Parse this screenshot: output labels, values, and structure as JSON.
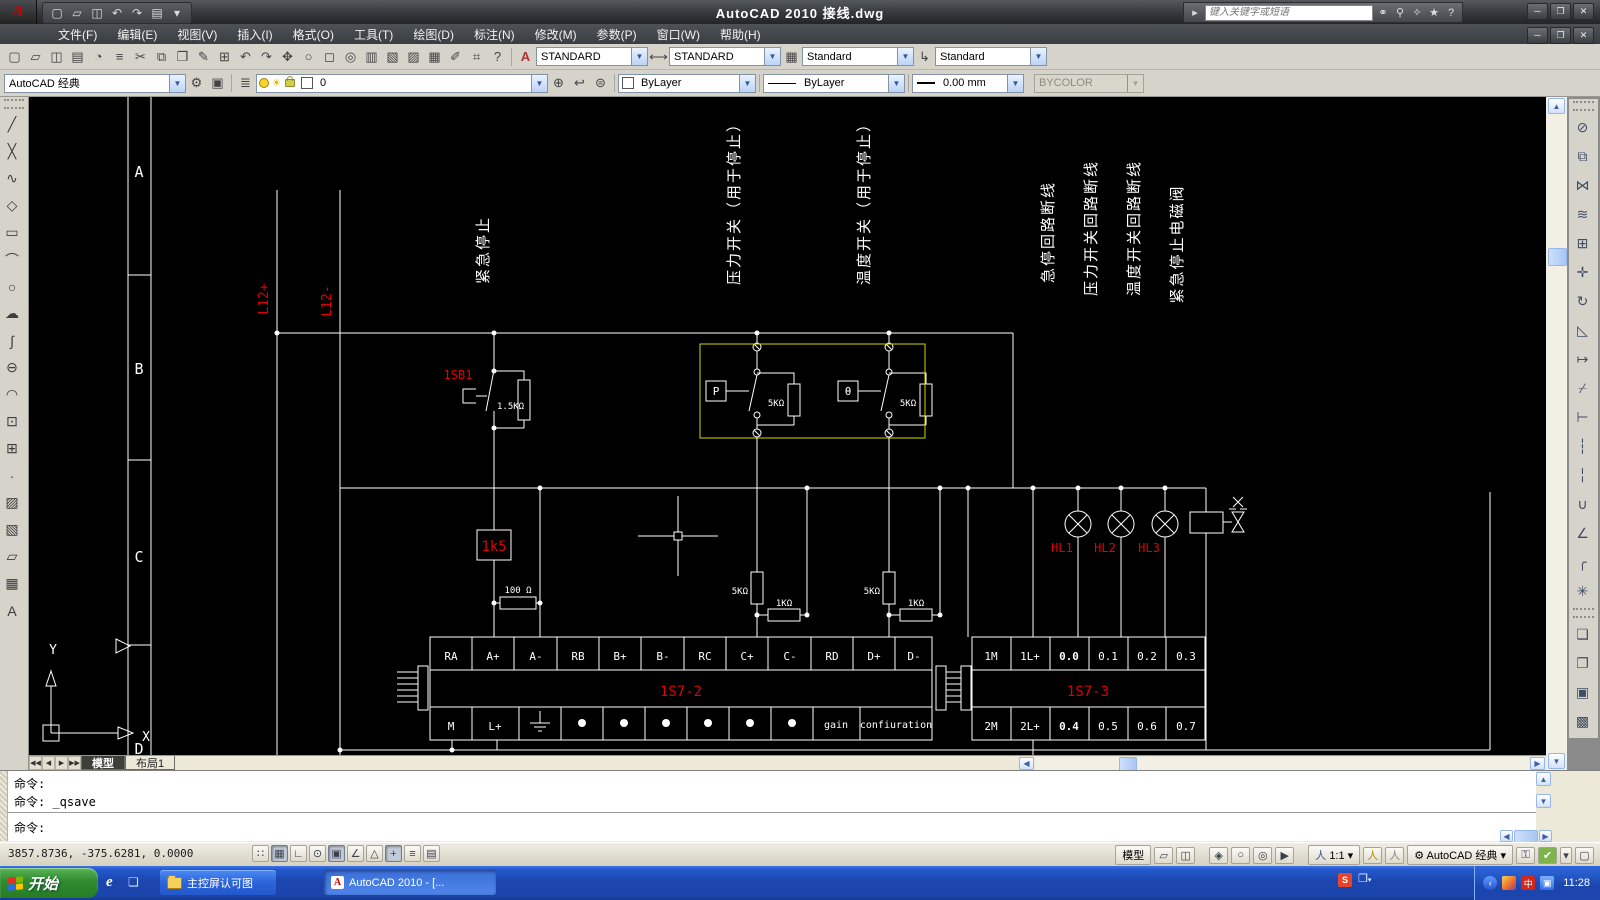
{
  "window": {
    "title": "AutoCAD 2010  接线.dwg",
    "search_placeholder": "键入关键字或短语"
  },
  "qat": {
    "icons": [
      {
        "name": "new-icon",
        "glyph": "▢"
      },
      {
        "name": "open-icon",
        "glyph": "▱"
      },
      {
        "name": "save-icon",
        "glyph": "◫"
      },
      {
        "name": "undo-icon",
        "glyph": "↶"
      },
      {
        "name": "redo-icon",
        "glyph": "↷"
      },
      {
        "name": "plot-icon",
        "glyph": "▤"
      },
      {
        "name": "qat-caret-icon",
        "glyph": "▾"
      }
    ]
  },
  "infocenter": {
    "icons": [
      {
        "name": "search-icon",
        "glyph": "⚭"
      },
      {
        "name": "key-icon",
        "glyph": "⚲"
      },
      {
        "name": "communication-icon",
        "glyph": "✧"
      },
      {
        "name": "favorites-icon",
        "glyph": "★"
      },
      {
        "name": "help-icon",
        "glyph": "?"
      }
    ]
  },
  "menu": {
    "items": [
      {
        "label": "文件(F)"
      },
      {
        "label": "编辑(E)"
      },
      {
        "label": "视图(V)"
      },
      {
        "label": "插入(I)"
      },
      {
        "label": "格式(O)"
      },
      {
        "label": "工具(T)"
      },
      {
        "label": "绘图(D)"
      },
      {
        "label": "标注(N)"
      },
      {
        "label": "修改(M)"
      },
      {
        "label": "参数(P)"
      },
      {
        "label": "窗口(W)"
      },
      {
        "label": "帮助(H)"
      }
    ]
  },
  "toolbar_standard": {
    "icons": [
      {
        "name": "new-icon",
        "glyph": "▢"
      },
      {
        "name": "open-icon",
        "glyph": "▱"
      },
      {
        "name": "save-icon",
        "glyph": "◫"
      },
      {
        "name": "plot-icon",
        "glyph": "▤"
      },
      {
        "name": "plot-preview-icon",
        "glyph": "◔"
      },
      {
        "name": "publish-icon",
        "glyph": "≡"
      },
      {
        "name": "cut-icon",
        "glyph": "✂"
      },
      {
        "name": "copy-clip-icon",
        "glyph": "⧉"
      },
      {
        "name": "paste-icon",
        "glyph": "❐"
      },
      {
        "name": "match-properties-icon",
        "glyph": "✎"
      },
      {
        "name": "block-editor-icon",
        "glyph": "⊞"
      },
      {
        "name": "undo-icon",
        "glyph": "↶"
      },
      {
        "name": "redo-icon",
        "glyph": "↷"
      },
      {
        "name": "pan-icon",
        "glyph": "✥"
      },
      {
        "name": "zoom-realtime-icon",
        "glyph": "○"
      },
      {
        "name": "zoom-window-icon",
        "glyph": "◻"
      },
      {
        "name": "zoom-previous-icon",
        "glyph": "◎"
      },
      {
        "name": "properties-icon",
        "glyph": "▥"
      },
      {
        "name": "designcenter-icon",
        "glyph": "▧"
      },
      {
        "name": "tool-palettes-icon",
        "glyph": "▨"
      },
      {
        "name": "sheetset-icon",
        "glyph": "▦"
      },
      {
        "name": "markup-icon",
        "glyph": "✐"
      },
      {
        "name": "quickcalc-icon",
        "glyph": "⌗"
      },
      {
        "name": "help-icon",
        "glyph": "?"
      }
    ],
    "text_style": "STANDARD",
    "dim_style": "STANDARD",
    "table_style": "Standard",
    "mleader_style": "Standard"
  },
  "toolbar_properties": {
    "workspace": "AutoCAD 经典",
    "layer": "0",
    "color": "ByLayer",
    "linetype": "ByLayer",
    "lineweight": "0.00 mm",
    "plotstyle": "BYCOLOR"
  },
  "draw_toolbar": {
    "icons": [
      {
        "name": "line-icon",
        "glyph": "╱"
      },
      {
        "name": "construction-line-icon",
        "glyph": "╳"
      },
      {
        "name": "polyline-icon",
        "glyph": "∿"
      },
      {
        "name": "polygon-icon",
        "glyph": "◇"
      },
      {
        "name": "rectangle-icon",
        "glyph": "▭"
      },
      {
        "name": "arc-icon",
        "glyph": "⌒"
      },
      {
        "name": "circle-icon",
        "glyph": "○"
      },
      {
        "name": "revcloud-icon",
        "glyph": "☁"
      },
      {
        "name": "spline-icon",
        "glyph": "∫"
      },
      {
        "name": "ellipse-icon",
        "glyph": "⊖"
      },
      {
        "name": "ellipse-arc-icon",
        "glyph": "◠"
      },
      {
        "name": "insert-block-icon",
        "glyph": "⊡"
      },
      {
        "name": "make-block-icon",
        "glyph": "⊞"
      },
      {
        "name": "point-icon",
        "glyph": "∙"
      },
      {
        "name": "hatch-icon",
        "glyph": "▨"
      },
      {
        "name": "gradient-icon",
        "glyph": "▧"
      },
      {
        "name": "region-icon",
        "glyph": "▱"
      },
      {
        "name": "table-icon",
        "glyph": "▦"
      },
      {
        "name": "mtext-icon",
        "glyph": "A"
      }
    ]
  },
  "modify_toolbar": {
    "icons": [
      {
        "name": "erase-icon",
        "glyph": "⊘"
      },
      {
        "name": "copy-icon",
        "glyph": "⧉"
      },
      {
        "name": "mirror-icon",
        "glyph": "⋈"
      },
      {
        "name": "offset-icon",
        "glyph": "≋"
      },
      {
        "name": "array-icon",
        "glyph": "⊞"
      },
      {
        "name": "move-icon",
        "glyph": "✛"
      },
      {
        "name": "rotate-icon",
        "glyph": "↻"
      },
      {
        "name": "scale-icon",
        "glyph": "◺"
      },
      {
        "name": "stretch-icon",
        "glyph": "↦"
      },
      {
        "name": "trim-icon",
        "glyph": "⌿"
      },
      {
        "name": "extend-icon",
        "glyph": "⊢"
      },
      {
        "name": "break-point-icon",
        "glyph": "┆"
      },
      {
        "name": "break-icon",
        "glyph": "╎"
      },
      {
        "name": "join-icon",
        "glyph": "∪"
      },
      {
        "name": "chamfer-icon",
        "glyph": "∠"
      },
      {
        "name": "fillet-icon",
        "glyph": "╭"
      },
      {
        "name": "explode-icon",
        "glyph": "✳"
      }
    ]
  },
  "draworder_toolbar": {
    "icons": [
      {
        "name": "bring-front-icon",
        "glyph": "❏"
      },
      {
        "name": "send-back-icon",
        "glyph": "❐"
      },
      {
        "name": "bring-above-icon",
        "glyph": "▣"
      },
      {
        "name": "send-under-icon",
        "glyph": "▩"
      }
    ]
  },
  "drawing": {
    "zones": {
      "a": "A",
      "b": "B",
      "c": "C",
      "d": "D"
    },
    "axis": {
      "x": "X",
      "y": "Y"
    },
    "bus": {
      "l12p": "L12+",
      "l12m": "L12-"
    },
    "labels": {
      "emergency": "紧急停止",
      "pressure": "压力开关（用于停止）",
      "temp": "温度开关（用于停止）",
      "estop_line": "急停回路断线",
      "pressure_line": "压力开关回路断线",
      "temp_line": "温度开关回路断线",
      "valve": "紧急停止电磁阀"
    },
    "red": {
      "sb1": "1SB1",
      "r1k5": "1k5",
      "hl1": "HL1",
      "hl2": "HL2",
      "hl3": "HL3",
      "ts2": "1S7-2",
      "ts3": "1S7-3"
    },
    "values": {
      "r15k": "1.5KΩ",
      "r5k": "5KΩ",
      "r1k": "1KΩ",
      "r100": "100 Ω",
      "p": "P",
      "theta": "θ"
    },
    "t2_row1": [
      "RA",
      "A+",
      "A-",
      "RB",
      "B+",
      "B-",
      "RC",
      "C+",
      "C-",
      "RD",
      "D+",
      "D-"
    ],
    "t2_row2": {
      "m": "M",
      "lp": "L+",
      "gain": "gain",
      "conf": "confiuration"
    },
    "t3_row1": [
      "1M",
      "1L+",
      "0.0",
      "0.1",
      "0.2",
      "0.3"
    ],
    "t3_row2": [
      "2M",
      "2L+",
      "0.4",
      "0.5",
      "0.6",
      "0.7"
    ]
  },
  "tabs": {
    "model": "模型",
    "layout1": "布局1"
  },
  "command": {
    "line1": "命令:",
    "line2": "命令: _qsave",
    "prompt": "命令:"
  },
  "statusbar": {
    "coords": "3857.8736, -375.6281, 0.0000",
    "toggles": [
      {
        "name": "snap-toggle",
        "glyph": "∷"
      },
      {
        "name": "grid-toggle",
        "glyph": "▦"
      },
      {
        "name": "ortho-toggle",
        "glyph": "∟"
      },
      {
        "name": "polar-toggle",
        "glyph": "⊙"
      },
      {
        "name": "osnap-toggle",
        "glyph": "▣"
      },
      {
        "name": "otrack-toggle",
        "glyph": "∠"
      },
      {
        "name": "ducs-toggle",
        "glyph": "△"
      },
      {
        "name": "dyn-toggle",
        "glyph": "+"
      },
      {
        "name": "lwt-toggle",
        "glyph": "≡"
      },
      {
        "name": "qp-toggle",
        "glyph": "▤"
      }
    ],
    "model_label": "模型",
    "annotation_scale": "1:1",
    "workspace": "AutoCAD 经典"
  },
  "taskbar": {
    "start": "开始",
    "task1": "主控屏认可图",
    "task2": "AutoCAD 2010 - [...",
    "sogou": "S",
    "ime": "中",
    "time": "11:28"
  }
}
